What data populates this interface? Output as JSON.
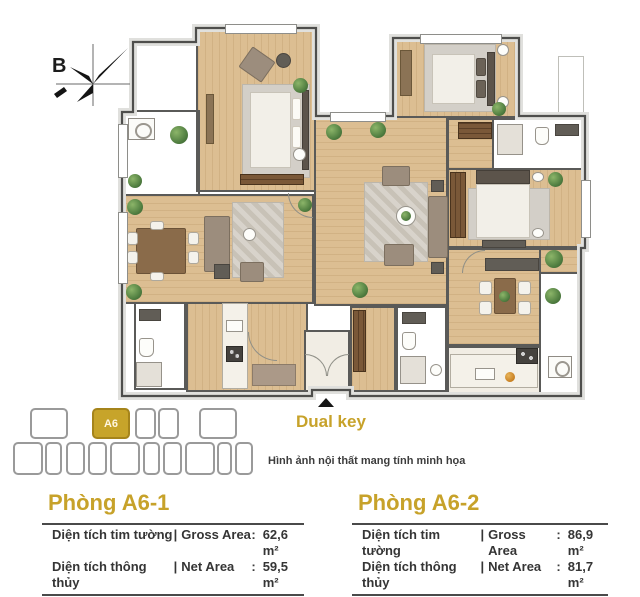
{
  "palette": {
    "accent_gold": "#C7A22A",
    "text_dark": "#3C3C3C",
    "wall": "#4E4E4C",
    "wood_floor": "#DCBE92",
    "tile_floor": "#D5D5D2",
    "plant_green": "#4E7C3F"
  },
  "compass": {
    "label": "B"
  },
  "keyplan": {
    "rows": [
      {
        "cells": [
          {
            "x": 30,
            "w": 38
          },
          {
            "x": 92,
            "w": 38,
            "label": "A6",
            "active": true
          },
          {
            "x": 135,
            "w": 21
          },
          {
            "x": 158,
            "w": 21
          },
          {
            "x": 199,
            "w": 38
          }
        ]
      },
      {
        "cells": [
          {
            "x": 13,
            "w": 30
          },
          {
            "x": 45,
            "w": 17
          },
          {
            "x": 66,
            "w": 19
          },
          {
            "x": 88,
            "w": 19
          },
          {
            "x": 110,
            "w": 30
          },
          {
            "x": 143,
            "w": 17
          },
          {
            "x": 163,
            "w": 19
          },
          {
            "x": 185,
            "w": 30
          },
          {
            "x": 217,
            "w": 15
          },
          {
            "x": 235,
            "w": 18
          }
        ]
      }
    ]
  },
  "dual_key": {
    "label": "Dual key"
  },
  "disclaimer": "Hình ảnh nội thất mang tính minh họa",
  "separators": {
    "pipe": "|",
    "colon": ":"
  },
  "units": [
    {
      "title": "Phòng A6-1",
      "rows": [
        {
          "vi": "Diện tích tim tường",
          "en": "Gross Area",
          "value": "62,6 m²"
        },
        {
          "vi": "Diện tích thông thủy",
          "en": "Net Area",
          "value": "59,5 m²"
        }
      ]
    },
    {
      "title": "Phòng A6-2",
      "rows": [
        {
          "vi": "Diện tích tim tường",
          "en": "Gross Area",
          "value": "86,9 m²"
        },
        {
          "vi": "Diện tích thông thủy",
          "en": "Net Area",
          "value": "81,7 m²"
        }
      ]
    }
  ]
}
